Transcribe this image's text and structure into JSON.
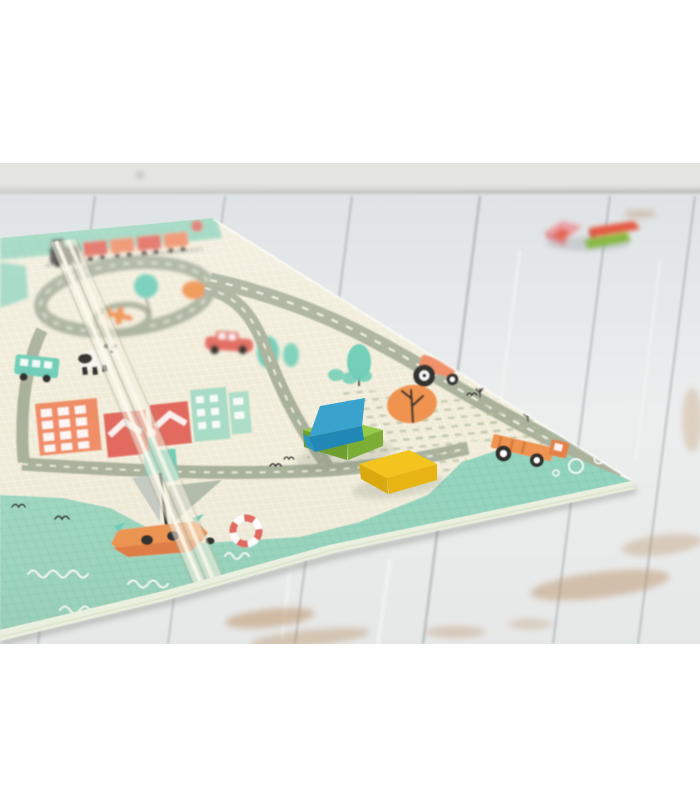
{
  "meta": {
    "description": "Product photograph of a foldable baby play mat with a pastel town-and-roads print lying on a whitewashed wooden floor. Three wooden blocks (blue, green, yellow) sit in sharp focus on the mat; a few small blurred blocks lie on the floor in the background."
  },
  "scene": {
    "labels": {
      "photo": "photo of folding play mat on wooden floor",
      "wall": "blurred wall with baseboard",
      "floor": "whitewashed wooden plank floor",
      "mat": "folding baby play mat with town road print",
      "crease": "fold crease of the mat",
      "train": "toy train print along mat top edge",
      "roundabout": "road loop with airplane roundabout",
      "panda": "panda print",
      "sailboat": "sailboat and lifebuoy harbor print",
      "truck": "orange truck print",
      "tractor": "tractor print",
      "car": "red car print",
      "orange_tree": "orange tree print",
      "blue_block": "blue wooden block",
      "green_block": "green wooden block",
      "yellow_block": "yellow wooden block",
      "distant_blocks": "small toy blocks on the floor"
    }
  },
  "colors": {
    "frame": "#ffffff",
    "wall": "#e4e4e0",
    "wall_dark": "#c9cac6",
    "baseboard_shadow": "#9fa19e",
    "floor_top": "#dfe3e5",
    "floor_mid": "#eceeee",
    "floor_low": "#e6e8e8",
    "plank_seam": "#a8adb0",
    "wood_wear": "#b98b5e",
    "mat_cream": "#f1ecd9",
    "mat_grid": "#ffffff",
    "mint": "#9fd8c1",
    "mint_bright": "#8fd3be",
    "mint_grid": "#57a183",
    "mat_side": "#eaf0de",
    "sage_road": "#a9b19b",
    "road_dash": "#fdfbee",
    "sage_dash": "#b3bda0",
    "coral": "#ef8d66",
    "orange": "#ef9350",
    "red": "#e2695d",
    "teal": "#6ecdb6",
    "teal_light": "#a8dcc6",
    "gray_sail": "#c6cbc2",
    "sail_dark": "#b2bcaa",
    "ink": "#2e2d2b",
    "train_engine": "#4c4b47",
    "white": "#ffffff",
    "crease_light": "#fcf9ee",
    "crease_mid": "#f5f0df",
    "crease_shadow": "#8a8f80",
    "block_blue_top": "#3aa3cd",
    "block_blue_front": "#2187b5",
    "block_blue_end": "#2d97c3",
    "block_green_top": "#96cb4a",
    "block_green_front": "#6e9e2e",
    "block_green_end": "#7cae36",
    "block_yellow_top": "#f2c41d",
    "block_yellow_front": "#d9a90f",
    "block_yellow_end": "#e7b414",
    "far_pink": "#e9a0a4",
    "far_red": "#e4583f",
    "far_green": "#86b93f",
    "shadow": "#6b7468"
  }
}
